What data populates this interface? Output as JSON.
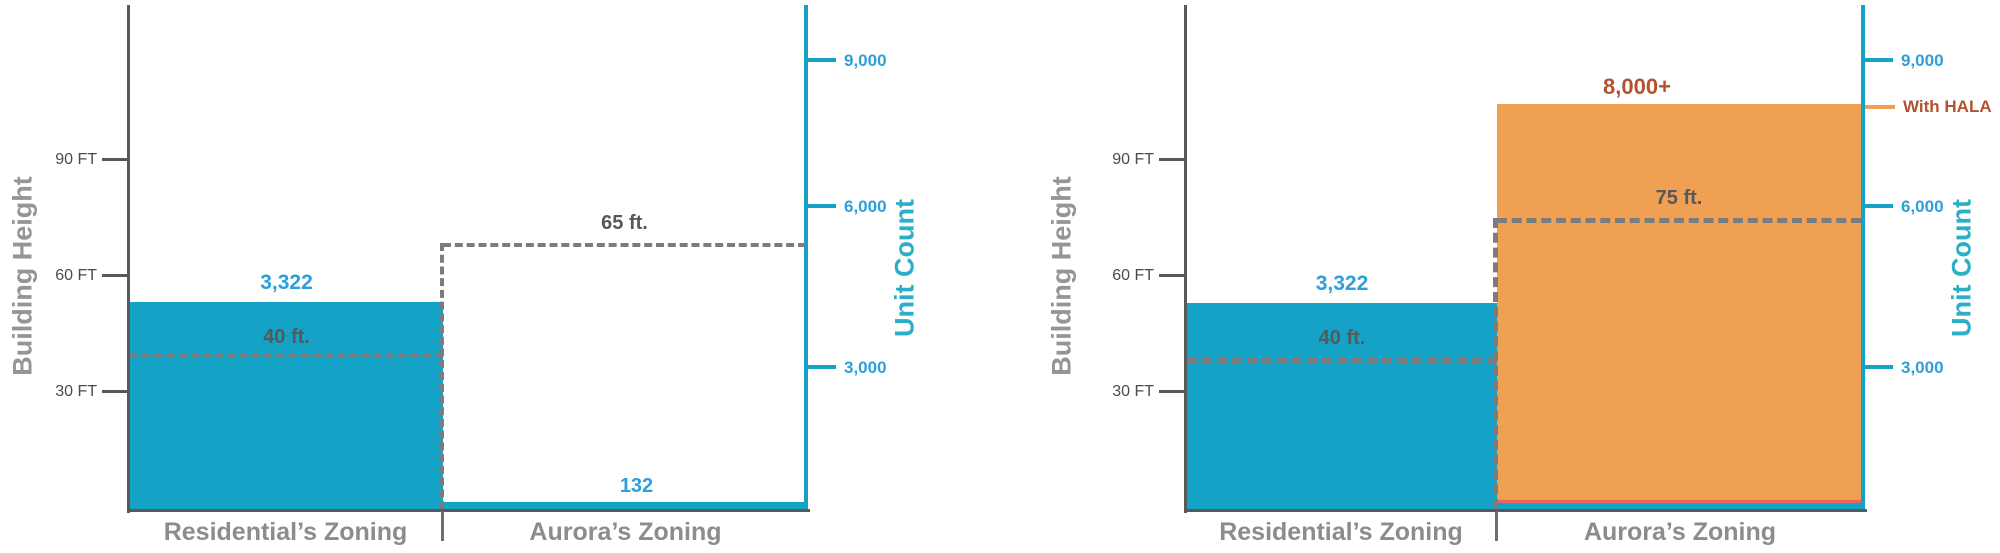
{
  "charts": [
    {
      "left_axis_title": "Building Height",
      "right_axis_title": "Unit Count",
      "ft_ticks": [
        "90 FT",
        "60 FT",
        "30 FT"
      ],
      "unit_ticks": [
        "9,000",
        "6,000",
        "3,000"
      ],
      "categories": [
        "Residential’s Zoning",
        "Aurora’s Zoning"
      ],
      "labels": {
        "residential_units": "3,322",
        "residential_height": "40 ft.",
        "aurora_units": "132",
        "aurora_height": "65 ft."
      }
    },
    {
      "left_axis_title": "Building Height",
      "right_axis_title": "Unit Count",
      "ft_ticks": [
        "90 FT",
        "60 FT",
        "30 FT"
      ],
      "unit_ticks": [
        "9,000",
        "6,000",
        "3,000"
      ],
      "categories": [
        "Residential’s Zoning",
        "Aurora’s Zoning"
      ],
      "labels": {
        "residential_units": "3,322",
        "residential_height": "40 ft.",
        "aurora_units": "8,000+",
        "aurora_height": "75 ft.",
        "hala_annotation": "With HALA"
      }
    }
  ],
  "colors": {
    "bar_cyan": "#14A3C6",
    "bar_orange": "#F0A053",
    "orange_bottom_line": "#E4685E",
    "unit_label_blue": "#2E9FDB",
    "unit_axis_teal": "#2BAEC7",
    "hala_brick": "#B5512F",
    "axis_gray": "#58595B",
    "text_gray": "#8A8C8F",
    "dash_gray": "#7C7C7E"
  },
  "chart_data": [
    {
      "type": "bar",
      "title": "",
      "categories": [
        "Residential’s Zoning",
        "Aurora’s Zoning"
      ],
      "series": [
        {
          "name": "Unit Count",
          "axis": "right",
          "values": [
            3322,
            132
          ],
          "value_labels": [
            "3,322",
            "132"
          ],
          "colors": [
            "#14A3C6",
            "#14A3C6"
          ]
        },
        {
          "name": "Allowed Building Height (ft)",
          "axis": "left",
          "values": [
            40,
            65
          ],
          "value_labels": [
            "40 ft.",
            "65 ft."
          ],
          "style": "dashed-outline"
        }
      ],
      "left_axis": {
        "label": "Building Height",
        "unit": "FT",
        "ticks": [
          30,
          60,
          90
        ]
      },
      "right_axis": {
        "label": "Unit Count",
        "ticks": [
          3000,
          6000,
          9000
        ]
      },
      "legend": "none",
      "grid": false
    },
    {
      "type": "bar",
      "title": "",
      "categories": [
        "Residential’s Zoning",
        "Aurora’s Zoning"
      ],
      "series": [
        {
          "name": "Unit Count",
          "axis": "right",
          "values": [
            3322,
            8000
          ],
          "value_labels": [
            "3,322",
            "8,000+"
          ],
          "colors": [
            "#14A3C6",
            "#F0A053"
          ]
        },
        {
          "name": "Allowed Building Height (ft)",
          "axis": "left",
          "values": [
            40,
            75
          ],
          "value_labels": [
            "40 ft.",
            "75 ft."
          ],
          "style": "dashed-outline"
        }
      ],
      "left_axis": {
        "label": "Building Height",
        "unit": "FT",
        "ticks": [
          30,
          60,
          90
        ]
      },
      "right_axis": {
        "label": "Unit Count",
        "ticks": [
          3000,
          6000,
          9000
        ]
      },
      "annotations": [
        {
          "text": "With HALA",
          "position": "right-axis",
          "value": 8000
        }
      ],
      "legend": "none",
      "grid": false
    }
  ]
}
